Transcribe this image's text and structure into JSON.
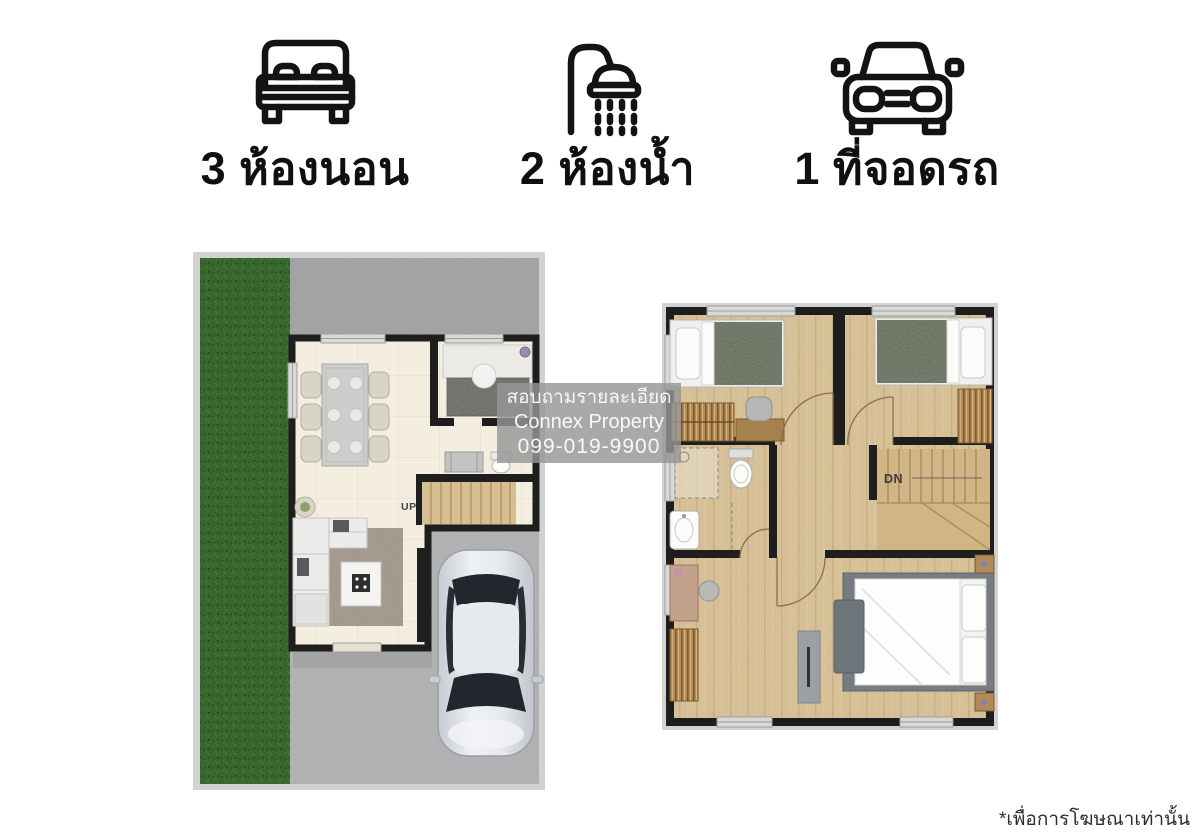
{
  "header": {
    "features": [
      {
        "icon": "bed-icon",
        "label": "3 ห้องนอน"
      },
      {
        "icon": "shower-icon",
        "label": "2 ห้องน้ำ"
      },
      {
        "icon": "car-icon",
        "label": "1 ที่จอดรถ"
      }
    ]
  },
  "watermark": {
    "line1": "สอบถามรายละเอียด",
    "line2": "Connex Property",
    "line3": "099-019-9900"
  },
  "disclaimer": "*เพื่อการโฆษณาเท่านั้น",
  "plans": {
    "first_floor": {
      "stair_label": "UP"
    },
    "second_floor": {
      "stair_label": "DN"
    }
  },
  "colors": {
    "wall": "#1e1e1e",
    "grass": "#47873a",
    "concrete_top": "#ababad",
    "driveway": "#bababc",
    "tile_floor": "#f3eee0",
    "wood_floor": "#dfc89d",
    "icon_stroke": "#131313",
    "watermark_bg": "rgba(150,150,150,0.82)"
  }
}
